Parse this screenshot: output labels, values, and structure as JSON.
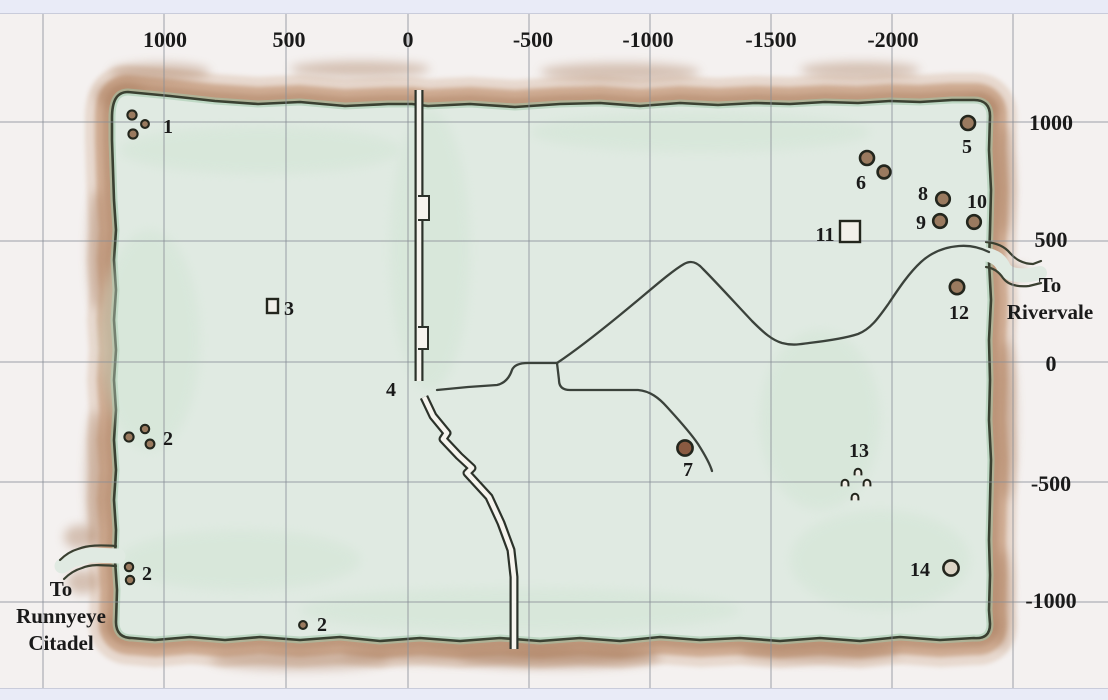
{
  "map_title": "zone-map-with-coordinate-grid",
  "colors": {
    "outer_background": "#f4f1f0",
    "edge_strip": "#e9ebf7",
    "grid_line": "#878d96",
    "land_fill": "#e0eae2",
    "land_outline": "#3a4031",
    "inner_shade": "#a3c9ab",
    "border_band_outer": "#ddc5b3",
    "border_band_mid": "#c79f82",
    "border_band_dark": "#aa7f61",
    "road": "#3b423b",
    "wall_line": "#2c322a",
    "wall_core": "#f6f4ee",
    "marker_ring": "#23261d",
    "marker_fill": "#9a7a5f",
    "label_text": "#1a1a1a"
  },
  "axes": {
    "top_ticks": [
      {
        "label": "1000",
        "x": 165
      },
      {
        "label": "500",
        "x": 289
      },
      {
        "label": "0",
        "x": 408
      },
      {
        "label": "-500",
        "x": 533
      },
      {
        "label": "-1000",
        "x": 648
      },
      {
        "label": "-1500",
        "x": 771
      },
      {
        "label": "-2000",
        "x": 893
      }
    ],
    "top_tick_baseline_y": 47,
    "right_ticks": [
      {
        "label": "1000",
        "y": 122
      },
      {
        "label": "500",
        "y": 239
      },
      {
        "label": "0",
        "y": 363
      },
      {
        "label": "-500",
        "y": 483
      },
      {
        "label": "-1000",
        "y": 600
      }
    ],
    "right_tick_center_x": 1051
  },
  "grid": {
    "vertical_x": [
      43,
      164,
      286,
      408,
      529,
      650,
      771,
      892,
      1013
    ],
    "horizontal_y": [
      122,
      241,
      362,
      482,
      602
    ],
    "top_clip_y": 13,
    "bottom_clip_y": 689
  },
  "terrain": {
    "land_path": "M 112,118 C 112,102 116,92 128,92 L 170,96 L 215,101 L 258,104 L 300,102 L 345,106 L 388,104 L 412,104 L 428,106 L 470,104 L 515,107 L 560,104 L 600,103 L 640,106 L 680,103 L 718,105 L 755,103 L 790,104 L 825,102 L 858,103 L 890,101 L 920,102 L 952,100 L 974,100 C 984,100 990,105 990,116 L 989,150 L 991,190 L 990,230 L 989,262 L 991,300 L 989,340 L 990,380 L 989,420 L 991,460 L 990,500 L 989,540 L 990,575 L 989,610 L 990,624 C 990,634 985,639 974,638 L 940,640 L 900,637 L 860,641 L 820,638 L 780,641 L 740,638 L 700,640 L 660,637 L 620,641 L 580,638 L 540,641 L 500,638 L 460,641 L 420,638 L 380,641 L 340,637 L 300,640 L 260,637 L 225,640 L 190,637 L 155,640 L 132,638 C 122,638 116,633 116,622 L 117,590 L 115,560 L 116,530 L 114,500 L 116,470 L 114,440 L 116,410 L 114,380 L 116,350 L 114,320 L 116,290 L 114,260 L 116,230 L 114,200 L 113,170 L 112,140 Z"
  },
  "exits": [
    {
      "name": "runnyeye-citadel-exit",
      "label_lines": [
        "To",
        "Runnyeye",
        "Citadel"
      ],
      "label_x": 61,
      "label_baselines": [
        596,
        623,
        650
      ],
      "channel_path": "M118,556 L90,555 L72,560 L62,566",
      "channel_width": 15,
      "wall_paths": [
        "M116,546 C100,545 88,545 78,549 C71,551 65,555 60,560",
        "M116,566 C102,565 91,564 82,568 C75,570 69,574 64,579"
      ]
    },
    {
      "name": "rivervale-exit",
      "label_lines": [
        "To",
        "Rivervale"
      ],
      "label_x": 1050,
      "label_baselines": [
        292,
        319
      ],
      "channel_path": "M984,254 C996,256 1001,261 1004,268 C1008,275 1018,276 1030,275 L1040,273",
      "channel_width": 14,
      "wall_paths": [
        "M986,242 C998,243 1005,247 1010,253 C1015,259 1023,264 1033,264 L1041,261",
        "M986,267 C994,268 999,272 1003,278 C1008,285 1018,287 1029,286 L1041,283"
      ]
    }
  ],
  "wall": {
    "name": "great-wall",
    "segments": [
      "M419,90 L419,381",
      "M424,397 L433,416 L447,433 L443,439 L459,456 L472,468 L467,473 L489,497 L501,523 L511,550 L514,577 L514,649"
    ],
    "notches": [
      "M418,196 h11 v24 h-11",
      "M418,327 h10 v22 h-10"
    ],
    "gap_label_marker": "4"
  },
  "roads": {
    "name": "trails",
    "paths": [
      "M437,390 L468,387 L497,385 C506,383 510,376 512,370 C514,365 520,363 528,363 L557,363",
      "M557,363 C572,353 598,333 620,315 C646,294 670,272 684,264 C691,260 697,262 703,269 C716,282 736,304 752,321 C764,333 772,340 782,343 C793,346 801,344 809,343 C826,341 846,338 858,334 C871,329 879,317 889,303 C899,288 909,273 921,262 C933,251 946,247 959,246 C971,245 981,248 989,252",
      "M557,363 L559,380 C559,386 562,390 570,390 L638,390 C650,391 659,398 667,407 C677,418 690,432 698,444 C705,455 710,464 712,471"
    ]
  },
  "markers": [
    {
      "id": "1",
      "label": "1",
      "lx": 168,
      "ly": 133,
      "symbols": [
        {
          "t": "dot",
          "x": 132,
          "y": 115,
          "r": 4.6
        },
        {
          "t": "dot",
          "x": 145,
          "y": 124,
          "r": 3.9
        },
        {
          "t": "dot",
          "x": 133,
          "y": 134,
          "r": 4.6
        }
      ]
    },
    {
      "id": "2a",
      "label": "2",
      "lx": 168,
      "ly": 445,
      "symbols": [
        {
          "t": "dot",
          "x": 129,
          "y": 437,
          "r": 4.6
        },
        {
          "t": "dot",
          "x": 145,
          "y": 429,
          "r": 4.2
        },
        {
          "t": "dot",
          "x": 150,
          "y": 444,
          "r": 4.4
        }
      ]
    },
    {
      "id": "2b",
      "label": "2",
      "lx": 147,
      "ly": 580,
      "symbols": [
        {
          "t": "dot",
          "x": 129,
          "y": 567,
          "r": 4.2
        },
        {
          "t": "dot",
          "x": 130,
          "y": 580,
          "r": 4.2
        }
      ]
    },
    {
      "id": "2c",
      "label": "2",
      "lx": 322,
      "ly": 631,
      "symbols": [
        {
          "t": "dot",
          "x": 303,
          "y": 625,
          "r": 3.9
        }
      ]
    },
    {
      "id": "3",
      "label": "3",
      "lx": 289,
      "ly": 315,
      "symbols": [
        {
          "t": "square",
          "x": 267,
          "y": 299,
          "w": 11,
          "h": 14
        }
      ]
    },
    {
      "id": "4",
      "label": "4",
      "lx": 391,
      "ly": 396,
      "symbols": []
    },
    {
      "id": "5",
      "label": "5",
      "lx": 967,
      "ly": 153,
      "symbols": [
        {
          "t": "dot",
          "x": 968,
          "y": 123,
          "r": 7
        }
      ]
    },
    {
      "id": "6",
      "label": "6",
      "lx": 861,
      "ly": 189,
      "symbols": [
        {
          "t": "dot",
          "x": 867,
          "y": 158,
          "r": 7
        },
        {
          "t": "dot",
          "x": 884,
          "y": 172,
          "r": 6.4
        }
      ]
    },
    {
      "id": "7",
      "label": "7",
      "lx": 688,
      "ly": 476,
      "symbols": [
        {
          "t": "dot",
          "x": 685,
          "y": 448,
          "r": 7.6,
          "fill": "#8a5a41"
        }
      ]
    },
    {
      "id": "8",
      "label": "8",
      "lx": 923,
      "ly": 200,
      "symbols": [
        {
          "t": "dot",
          "x": 943,
          "y": 199,
          "r": 6.8
        }
      ]
    },
    {
      "id": "9",
      "label": "9",
      "lx": 921,
      "ly": 229,
      "symbols": [
        {
          "t": "dot",
          "x": 940,
          "y": 221,
          "r": 6.8
        }
      ]
    },
    {
      "id": "10",
      "label": "10",
      "lx": 977,
      "ly": 208,
      "symbols": [
        {
          "t": "dot",
          "x": 974,
          "y": 222,
          "r": 6.8
        }
      ]
    },
    {
      "id": "11",
      "label": "11",
      "lx": 825,
      "ly": 241,
      "symbols": [
        {
          "t": "square",
          "x": 840,
          "y": 221,
          "w": 20,
          "h": 21
        }
      ]
    },
    {
      "id": "12",
      "label": "12",
      "lx": 959,
      "ly": 319,
      "symbols": [
        {
          "t": "dot",
          "x": 957,
          "y": 287,
          "r": 7.2
        }
      ]
    },
    {
      "id": "13",
      "label": "13",
      "lx": 859,
      "ly": 457,
      "symbols": [
        {
          "t": "cave",
          "x": 858,
          "y": 472
        },
        {
          "t": "cave",
          "x": 845,
          "y": 483
        },
        {
          "t": "cave",
          "x": 867,
          "y": 483
        },
        {
          "t": "cave",
          "x": 855,
          "y": 497
        }
      ]
    },
    {
      "id": "14",
      "label": "14",
      "lx": 920,
      "ly": 576,
      "symbols": [
        {
          "t": "dot",
          "x": 951,
          "y": 568,
          "r": 7.6,
          "fill": "#ddd5c6"
        }
      ]
    }
  ],
  "font_sizes": {
    "axis": 22,
    "marker": 20,
    "exit": 21
  }
}
